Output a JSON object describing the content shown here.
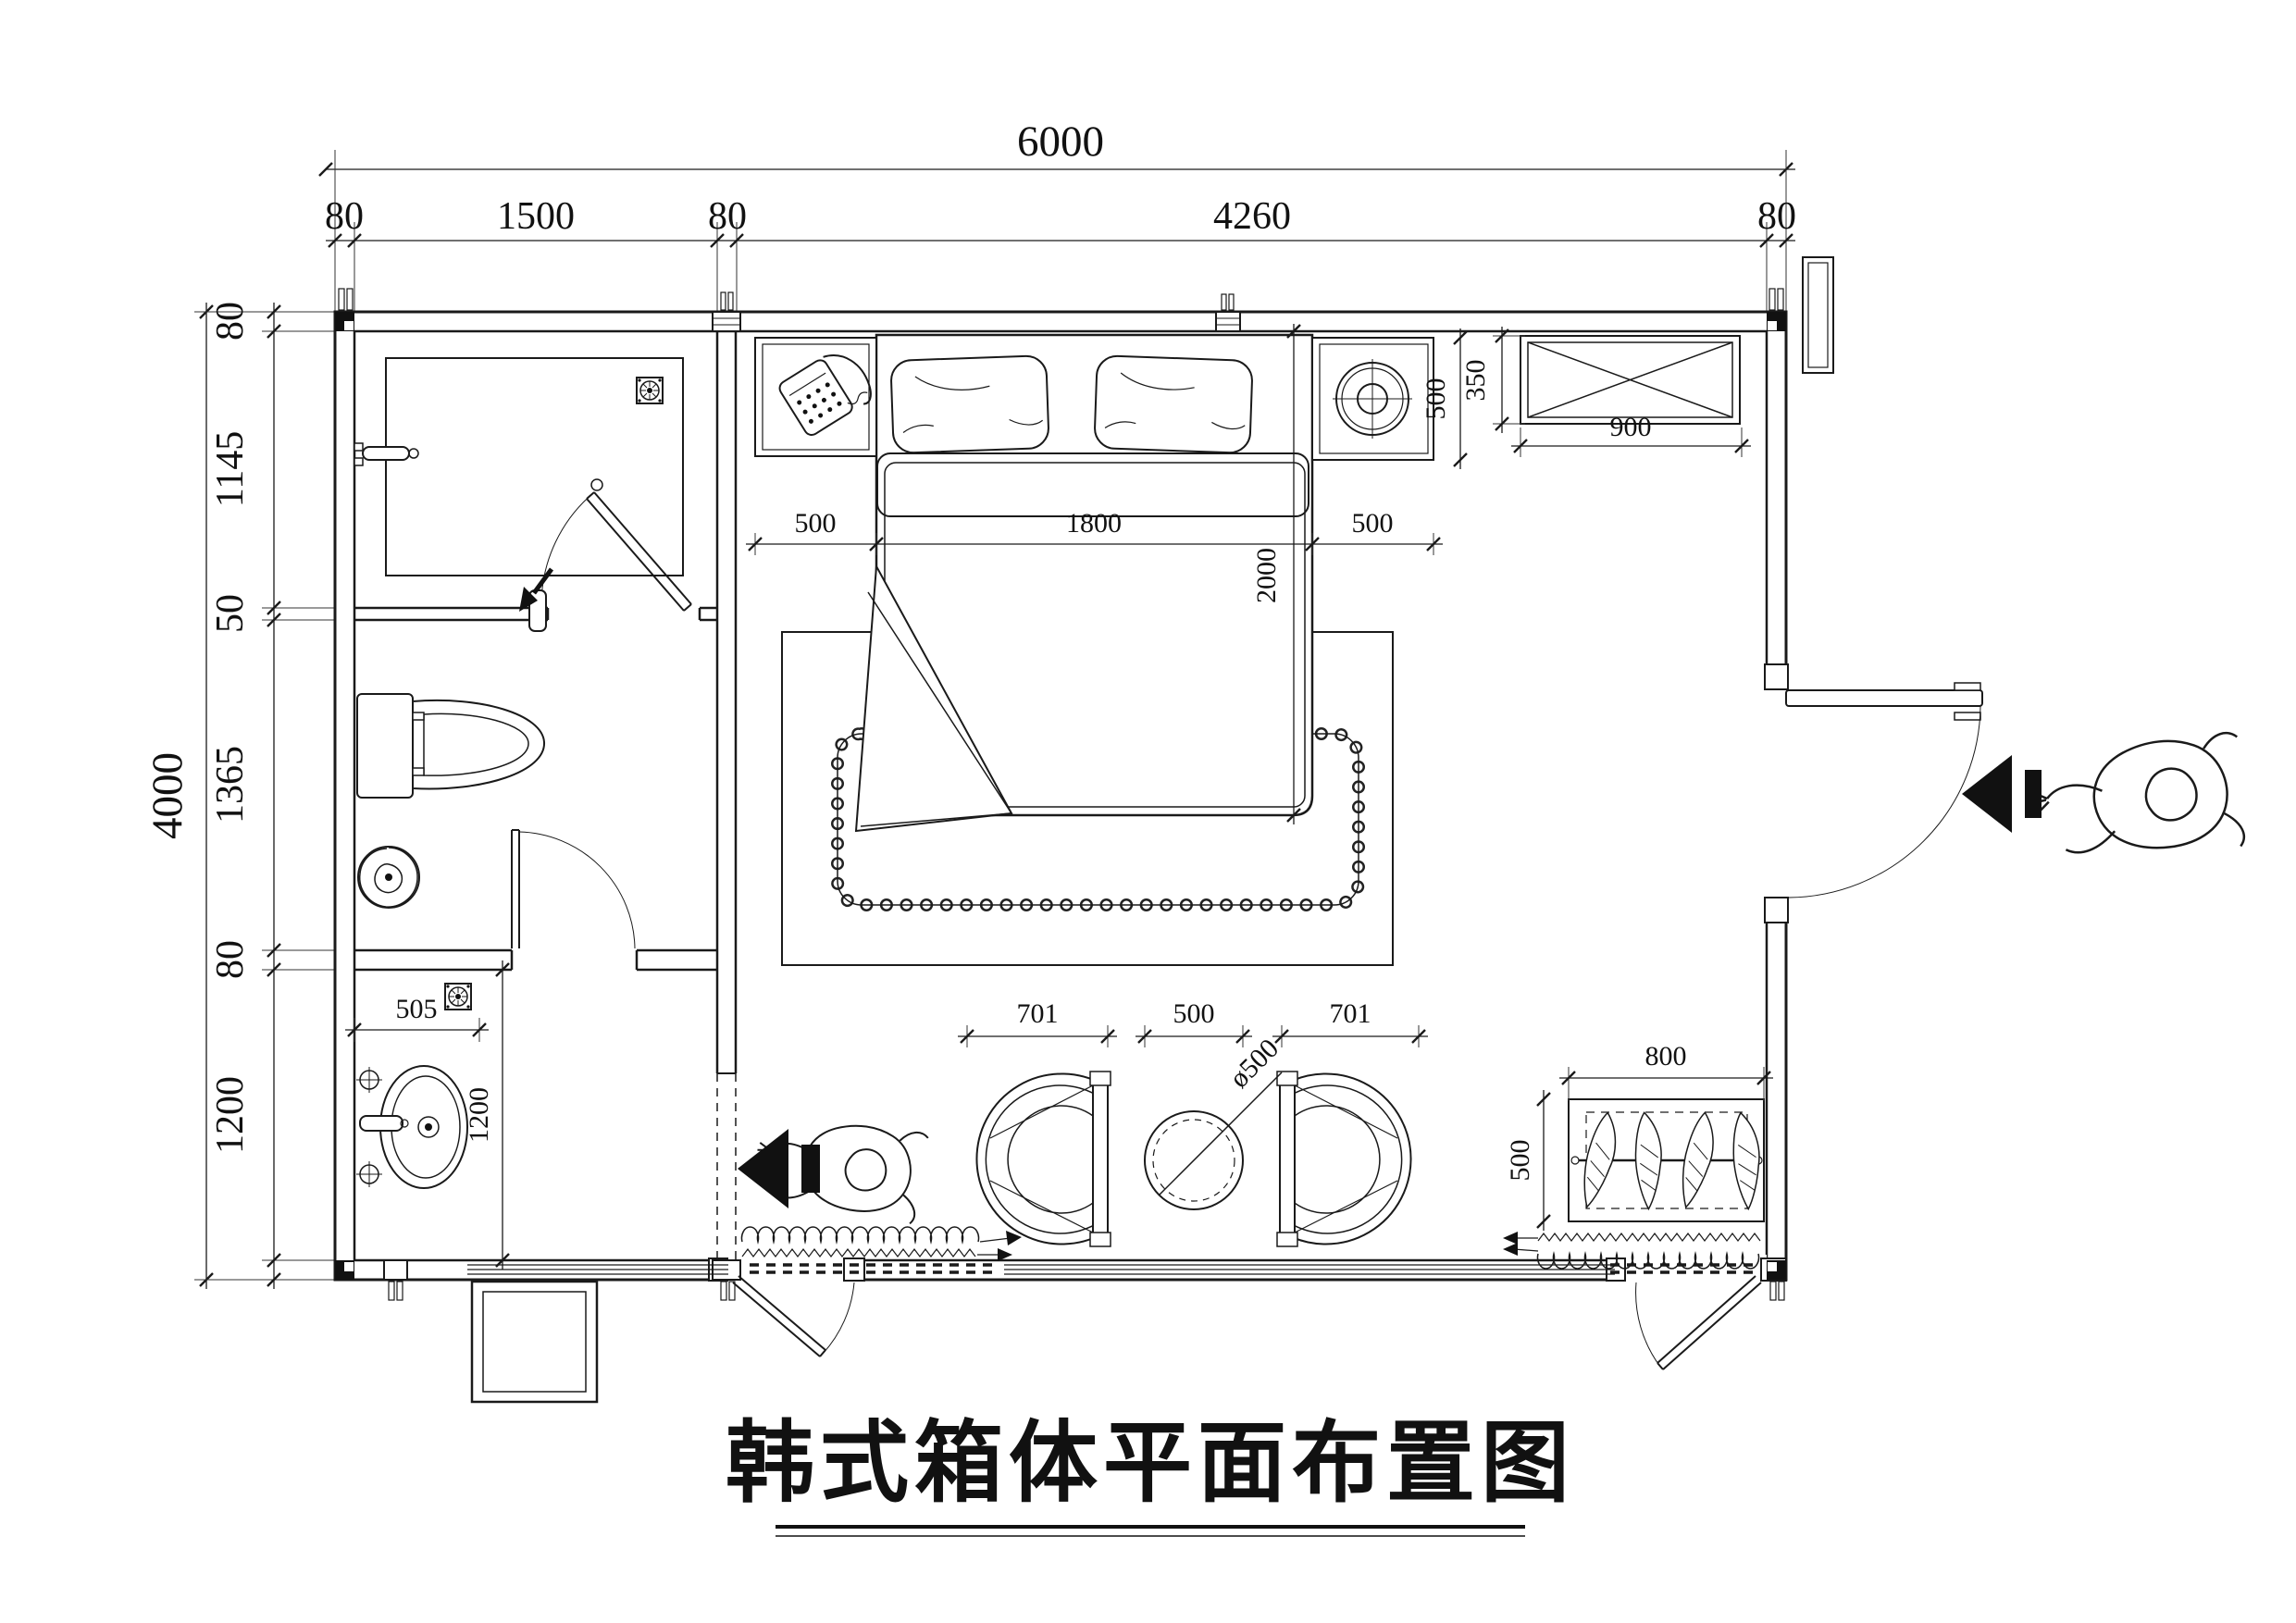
{
  "title": "韩式箱体平面布置图",
  "dimensions": {
    "overall_width": "6000",
    "overall_height": "4000",
    "top_chain": [
      "80",
      "1500",
      "80",
      "4260",
      "80"
    ],
    "left_chain": [
      "80",
      "1145",
      "50",
      "1365",
      "80",
      "1200"
    ],
    "bed": {
      "left_gap": "500",
      "width": "1800",
      "right_gap": "500",
      "length": "2000"
    },
    "right_nightstand_depth": "500",
    "cabinet": {
      "depth": "350",
      "width": "900"
    },
    "vanity": {
      "width": "505",
      "length": "1200"
    },
    "sitting": {
      "left_chair": "701",
      "gap": "500",
      "right_chair": "701",
      "table_diameter": "ø500"
    },
    "plant_box": {
      "width": "800",
      "depth": "500"
    }
  }
}
